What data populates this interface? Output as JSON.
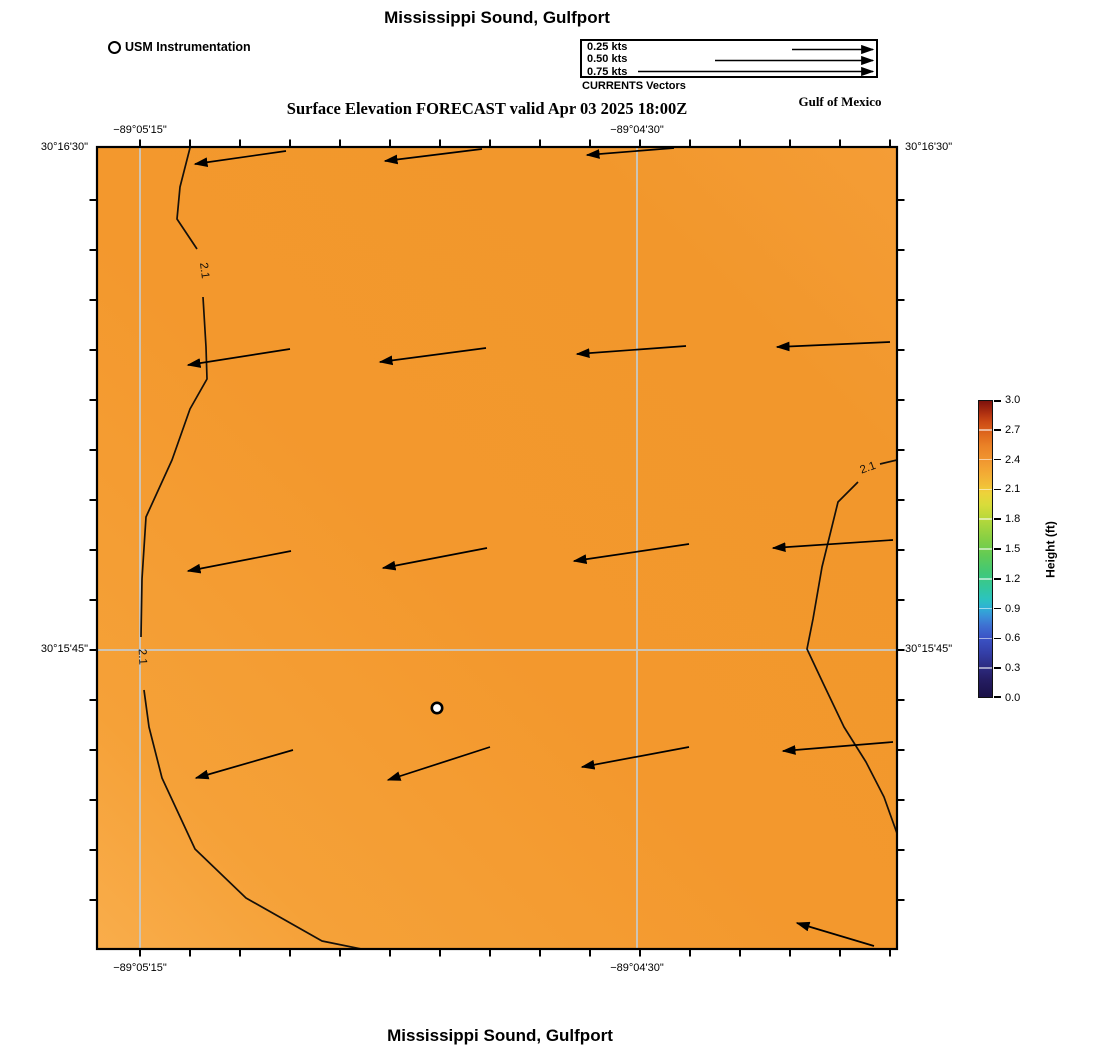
{
  "titles": {
    "top": "Mississippi Sound, Gulfport",
    "bottom": "Mississippi Sound, Gulfport"
  },
  "subtitle": "Surface Elevation FORECAST valid Apr 03 2025 18:00Z",
  "region_label": "Gulf of Mexico",
  "instrument_legend": {
    "label": "USM Instrumentation"
  },
  "vector_legend": {
    "caption": "CURRENTS Vectors",
    "items": [
      {
        "label": "0.25 kts",
        "tail_x": 210,
        "y": 8.5
      },
      {
        "label": "0.50 kts",
        "tail_x": 133,
        "y": 19.5
      },
      {
        "label": "0.75 kts",
        "tail_x": 56,
        "y": 30.5
      }
    ],
    "head_x": 291
  },
  "axis_labels": {
    "lon": [
      "−89°05'15\"",
      "−89°04'30\""
    ],
    "lat": [
      "30°16'30\"",
      "30°15'45\""
    ]
  },
  "colorbar": {
    "title": "Height (ft)",
    "tick_labels": [
      "3.0",
      "2.7",
      "2.4",
      "2.1",
      "1.8",
      "1.5",
      "1.2",
      "0.9",
      "0.6",
      "0.3",
      "0.0"
    ],
    "stops_bottom_to_top": [
      [
        0.0,
        "#1a1147"
      ],
      [
        0.06,
        "#251d63"
      ],
      [
        0.1,
        "#2d2b80"
      ],
      [
        0.15,
        "#343fa8"
      ],
      [
        0.2,
        "#3b53c6"
      ],
      [
        0.24,
        "#3e6fd1"
      ],
      [
        0.27,
        "#3a8ed8"
      ],
      [
        0.3,
        "#2fafd6"
      ],
      [
        0.33,
        "#2cc3c0"
      ],
      [
        0.37,
        "#33c79c"
      ],
      [
        0.42,
        "#41c877"
      ],
      [
        0.48,
        "#62cb54"
      ],
      [
        0.54,
        "#8ad043"
      ],
      [
        0.6,
        "#b5d83b"
      ],
      [
        0.65,
        "#d9dc3a"
      ],
      [
        0.69,
        "#eed23a"
      ],
      [
        0.72,
        "#f2bd38"
      ],
      [
        0.76,
        "#f3a934"
      ],
      [
        0.8,
        "#f09630"
      ],
      [
        0.85,
        "#ea8126"
      ],
      [
        0.89,
        "#de671d"
      ],
      [
        0.93,
        "#cc4a15"
      ],
      [
        0.96,
        "#ae2f10"
      ],
      [
        1.0,
        "#7d120c"
      ]
    ]
  },
  "chart_data": {
    "type": "heatmap",
    "title": "Mississippi Sound, Gulfport",
    "subtitle": "Surface Elevation FORECAST valid Apr 03 2025 18:00Z",
    "field": {
      "variable": "Surface Elevation",
      "units": "ft",
      "approx_value_range": [
        2.0,
        2.2
      ],
      "colorbar_range": [
        0.0,
        3.0
      ],
      "colorbar_tick_step": 0.3,
      "gradient": [
        [
          0.0,
          "#f9ad4b"
        ],
        [
          0.15,
          "#f5a138"
        ],
        [
          0.45,
          "#f3982d"
        ],
        [
          0.8,
          "#f2972c"
        ],
        [
          1.0,
          "#f49d36"
        ]
      ]
    },
    "axes": {
      "lon_ticks": [
        "-89°05'15\"",
        "-89°04'30\""
      ],
      "lat_ticks": [
        "30°16'30\"",
        "30°15'45\""
      ],
      "lon_tick_px": [
        140,
        637
      ],
      "lat_tick_px": [
        148,
        650
      ]
    },
    "grid": {
      "vertical_x": [
        43,
        540
      ],
      "horizontal_y": [
        503
      ],
      "color": "#cbc7bd",
      "opacity": 0.95
    },
    "frame_ticks": {
      "x": [
        43,
        93,
        143,
        193,
        243,
        293,
        343,
        393,
        443,
        493,
        543,
        593,
        643,
        693,
        743,
        793
      ],
      "y": [
        53,
        103,
        153,
        203,
        253,
        303,
        353,
        403,
        453,
        503,
        553,
        603,
        653,
        703,
        753
      ]
    },
    "contours": {
      "level": 2.1,
      "segments": [
        [
          [
            94,
            -3
          ],
          [
            83,
            40
          ],
          [
            80,
            72
          ],
          [
            100,
            102
          ]
        ],
        [
          [
            106,
            150
          ],
          [
            109,
            200
          ],
          [
            110,
            232
          ],
          [
            93,
            262
          ],
          [
            75,
            313
          ],
          [
            49,
            370
          ],
          [
            45,
            432
          ],
          [
            44,
            490
          ]
        ],
        [
          [
            47,
            543
          ],
          [
            52,
            580
          ],
          [
            65,
            631
          ],
          [
            98,
            702
          ],
          [
            149,
            751
          ],
          [
            225,
            794
          ],
          [
            284,
            806
          ]
        ],
        [
          [
            800,
            313
          ],
          [
            783,
            317
          ]
        ],
        [
          [
            761,
            335
          ],
          [
            741,
            355
          ],
          [
            725,
            420
          ],
          [
            716,
            472
          ],
          [
            710,
            502
          ],
          [
            726,
            536
          ],
          [
            747,
            580
          ],
          [
            769,
            615
          ],
          [
            787,
            650
          ],
          [
            802,
            692
          ]
        ]
      ],
      "labels": [
        {
          "text": "2.1",
          "x": 104,
          "y": 124,
          "rot": 83
        },
        {
          "text": "2.1",
          "x": 42,
          "y": 510,
          "rot": 87
        },
        {
          "text": "2.1",
          "x": 772,
          "y": 324,
          "rot": -20
        }
      ]
    },
    "vectors": {
      "kind": "currents",
      "direction": "westward",
      "arrows": [
        {
          "x1": 189,
          "y1": 4,
          "x2": 98,
          "y2": 17
        },
        {
          "x1": 385,
          "y1": 2,
          "x2": 288,
          "y2": 14
        },
        {
          "x1": 577,
          "y1": 1,
          "x2": 490,
          "y2": 8
        },
        {
          "x1": 193,
          "y1": 202,
          "x2": 91,
          "y2": 218
        },
        {
          "x1": 389,
          "y1": 201,
          "x2": 283,
          "y2": 215
        },
        {
          "x1": 589,
          "y1": 199,
          "x2": 480,
          "y2": 207
        },
        {
          "x1": 793,
          "y1": 195,
          "x2": 680,
          "y2": 200
        },
        {
          "x1": 194,
          "y1": 404,
          "x2": 91,
          "y2": 424
        },
        {
          "x1": 390,
          "y1": 401,
          "x2": 286,
          "y2": 421
        },
        {
          "x1": 592,
          "y1": 397,
          "x2": 477,
          "y2": 414
        },
        {
          "x1": 796,
          "y1": 393,
          "x2": 676,
          "y2": 401
        },
        {
          "x1": 196,
          "y1": 603,
          "x2": 99,
          "y2": 631
        },
        {
          "x1": 393,
          "y1": 600,
          "x2": 291,
          "y2": 633
        },
        {
          "x1": 592,
          "y1": 600,
          "x2": 485,
          "y2": 620
        },
        {
          "x1": 796,
          "y1": 595,
          "x2": 686,
          "y2": 604
        },
        {
          "x1": 777,
          "y1": 799,
          "x2": 700,
          "y2": 776
        }
      ]
    },
    "marker": {
      "x": 340,
      "y": 561,
      "label": "USM Instrumentation"
    }
  }
}
